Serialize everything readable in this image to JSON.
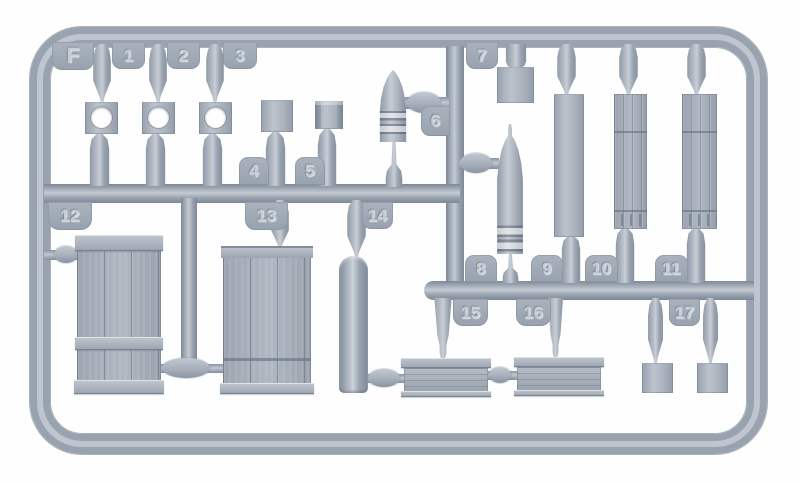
{
  "sprue": {
    "letter": "F",
    "material_colors": {
      "plastic_base": "#9aa4b1",
      "plastic_light": "#c6ccd4",
      "plastic_dark": "#7b8593",
      "background": "#fefefe"
    },
    "tabs": [
      {
        "id": "F",
        "label": "F"
      },
      {
        "id": "1",
        "label": "1"
      },
      {
        "id": "2",
        "label": "2"
      },
      {
        "id": "3",
        "label": "3"
      },
      {
        "id": "4",
        "label": "4"
      },
      {
        "id": "5",
        "label": "5"
      },
      {
        "id": "6",
        "label": "6"
      },
      {
        "id": "7",
        "label": "7"
      },
      {
        "id": "8",
        "label": "8"
      },
      {
        "id": "9",
        "label": "9"
      },
      {
        "id": "10",
        "label": "10"
      },
      {
        "id": "11",
        "label": "11"
      },
      {
        "id": "12",
        "label": "12"
      },
      {
        "id": "13",
        "label": "13"
      },
      {
        "id": "14",
        "label": "14"
      },
      {
        "id": "15",
        "label": "15"
      },
      {
        "id": "16",
        "label": "16"
      },
      {
        "id": "17",
        "label": "17"
      }
    ]
  }
}
